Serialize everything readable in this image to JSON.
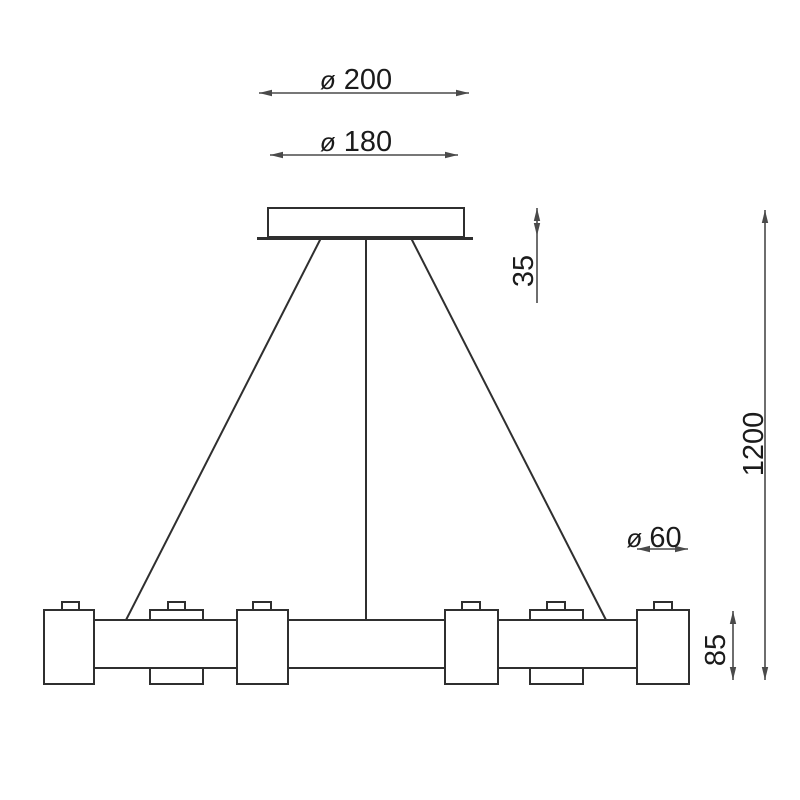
{
  "drawing": {
    "background": "#ffffff",
    "line_color": "#2f2f2f",
    "dim_line_color": "#4a4a4a",
    "text_color": "#1b1b1b",
    "dimensions": {
      "plate_diameter": {
        "symbol": "ø",
        "value": "200"
      },
      "canopy_diameter": {
        "symbol": "ø",
        "value": "180"
      },
      "canopy_height": {
        "value": "35"
      },
      "suspension_length": {
        "value": "1200"
      },
      "shade_diameter": {
        "symbol": "ø",
        "value": "60"
      },
      "shade_height": {
        "value": "85"
      }
    }
  }
}
